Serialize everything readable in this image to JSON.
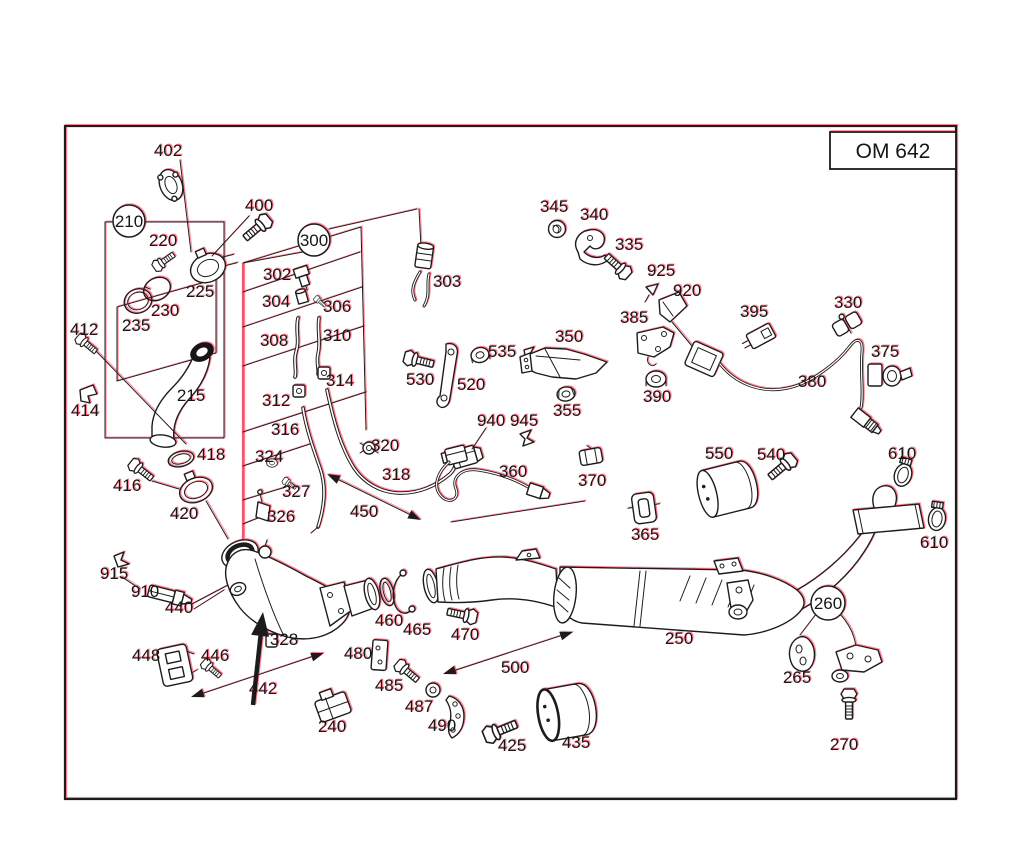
{
  "title_block": {
    "text": "OM 642"
  },
  "colors": {
    "line": "#1c1c1c",
    "red_fringe": "#ff4b63",
    "group_highlight_line": "#f2566e",
    "background": "#ffffff"
  },
  "part_labels": [
    {
      "text": "402",
      "x": 168,
      "y": 150
    },
    {
      "text": "400",
      "x": 259,
      "y": 205
    },
    {
      "text": "220",
      "x": 163,
      "y": 240
    },
    {
      "text": "225",
      "x": 200,
      "y": 291
    },
    {
      "text": "230",
      "x": 165,
      "y": 310
    },
    {
      "text": "235",
      "x": 136,
      "y": 325
    },
    {
      "text": "412",
      "x": 84,
      "y": 329
    },
    {
      "text": "414",
      "x": 85,
      "y": 410
    },
    {
      "text": "215",
      "x": 191,
      "y": 395
    },
    {
      "text": "302",
      "x": 277,
      "y": 274
    },
    {
      "text": "304",
      "x": 276,
      "y": 301
    },
    {
      "text": "306",
      "x": 337,
      "y": 306
    },
    {
      "text": "308",
      "x": 274,
      "y": 340
    },
    {
      "text": "310",
      "x": 337,
      "y": 335
    },
    {
      "text": "314",
      "x": 340,
      "y": 380
    },
    {
      "text": "312",
      "x": 276,
      "y": 400
    },
    {
      "text": "316",
      "x": 285,
      "y": 429
    },
    {
      "text": "324",
      "x": 269,
      "y": 456
    },
    {
      "text": "327",
      "x": 296,
      "y": 491
    },
    {
      "text": "326",
      "x": 281,
      "y": 516
    },
    {
      "text": "320",
      "x": 385,
      "y": 445
    },
    {
      "text": "318",
      "x": 396,
      "y": 474
    },
    {
      "text": "450",
      "x": 364,
      "y": 511
    },
    {
      "text": "418",
      "x": 211,
      "y": 454
    },
    {
      "text": "416",
      "x": 127,
      "y": 485
    },
    {
      "text": "420",
      "x": 184,
      "y": 513
    },
    {
      "text": "303",
      "x": 447,
      "y": 281
    },
    {
      "text": "345",
      "x": 554,
      "y": 206
    },
    {
      "text": "340",
      "x": 594,
      "y": 214
    },
    {
      "text": "335",
      "x": 629,
      "y": 244
    },
    {
      "text": "925",
      "x": 661,
      "y": 270
    },
    {
      "text": "920",
      "x": 687,
      "y": 290
    },
    {
      "text": "385",
      "x": 634,
      "y": 317
    },
    {
      "text": "395",
      "x": 754,
      "y": 311
    },
    {
      "text": "330",
      "x": 848,
      "y": 302
    },
    {
      "text": "350",
      "x": 569,
      "y": 336
    },
    {
      "text": "355",
      "x": 567,
      "y": 410
    },
    {
      "text": "390",
      "x": 657,
      "y": 396
    },
    {
      "text": "380",
      "x": 812,
      "y": 381
    },
    {
      "text": "375",
      "x": 885,
      "y": 351
    },
    {
      "text": "535",
      "x": 502,
      "y": 351
    },
    {
      "text": "530",
      "x": 420,
      "y": 379
    },
    {
      "text": "520",
      "x": 471,
      "y": 384
    },
    {
      "text": "940",
      "x": 491,
      "y": 420
    },
    {
      "text": "945",
      "x": 524,
      "y": 420
    },
    {
      "text": "360",
      "x": 513,
      "y": 471
    },
    {
      "text": "370",
      "x": 592,
      "y": 480
    },
    {
      "text": "365",
      "x": 645,
      "y": 534
    },
    {
      "text": "550",
      "x": 719,
      "y": 453
    },
    {
      "text": "540",
      "x": 771,
      "y": 454
    },
    {
      "text": "610",
      "x": 902,
      "y": 453
    },
    {
      "text": "610",
      "x": 934,
      "y": 542
    },
    {
      "text": "915",
      "x": 114,
      "y": 573
    },
    {
      "text": "910",
      "x": 145,
      "y": 591
    },
    {
      "text": "440",
      "x": 179,
      "y": 607
    },
    {
      "text": "328",
      "x": 284,
      "y": 639
    },
    {
      "text": "448",
      "x": 146,
      "y": 655
    },
    {
      "text": "446",
      "x": 215,
      "y": 655
    },
    {
      "text": "442",
      "x": 263,
      "y": 688
    },
    {
      "text": "460",
      "x": 389,
      "y": 620
    },
    {
      "text": "465",
      "x": 417,
      "y": 629
    },
    {
      "text": "470",
      "x": 465,
      "y": 634
    },
    {
      "text": "480",
      "x": 358,
      "y": 653
    },
    {
      "text": "485",
      "x": 389,
      "y": 685
    },
    {
      "text": "487",
      "x": 419,
      "y": 706
    },
    {
      "text": "490",
      "x": 442,
      "y": 725
    },
    {
      "text": "240",
      "x": 332,
      "y": 726
    },
    {
      "text": "425",
      "x": 512,
      "y": 745
    },
    {
      "text": "435",
      "x": 576,
      "y": 742
    },
    {
      "text": "500",
      "x": 515,
      "y": 667
    },
    {
      "text": "250",
      "x": 679,
      "y": 638
    },
    {
      "text": "265",
      "x": 797,
      "y": 677
    },
    {
      "text": "270",
      "x": 844,
      "y": 744
    },
    {
      "text": "210",
      "x": 129,
      "y": 221,
      "circled": true,
      "r": 16
    },
    {
      "text": "300",
      "x": 314,
      "y": 240,
      "circled": true,
      "r": 16
    },
    {
      "text": "260",
      "x": 828,
      "y": 603,
      "circled": true,
      "r": 17
    }
  ]
}
